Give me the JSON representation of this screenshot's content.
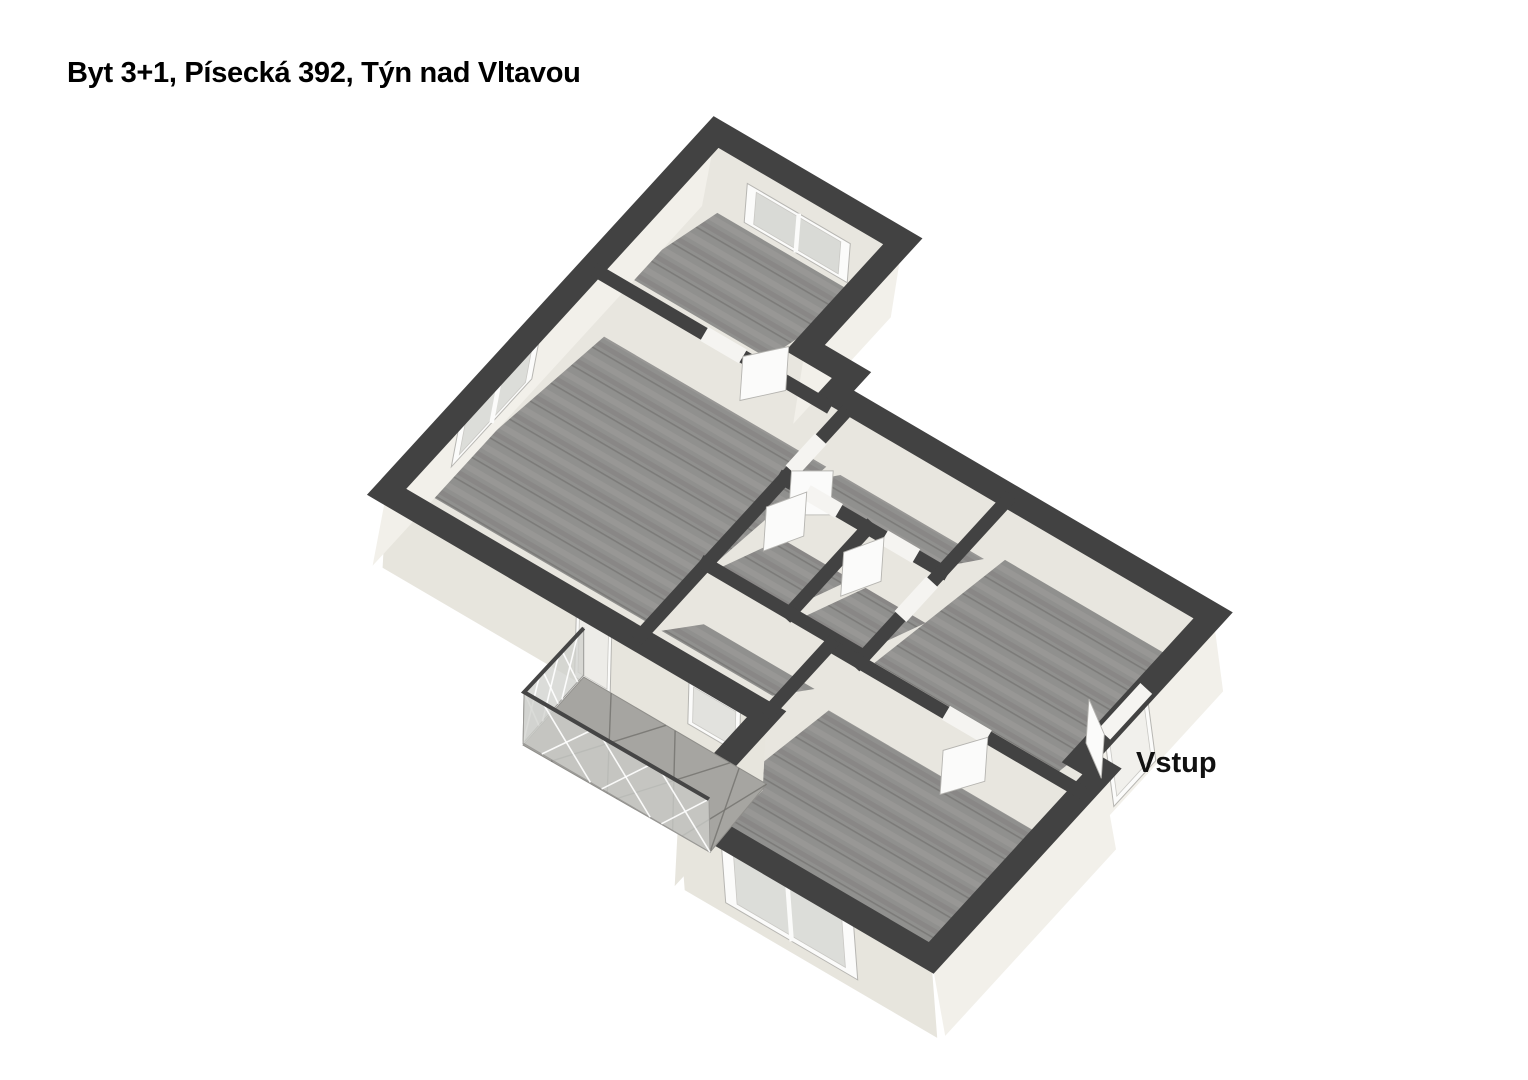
{
  "header": {
    "title": "Byt 3+1, Písecká 392, Týn nad Vltavou"
  },
  "plan": {
    "entrance_label": "Vstup",
    "projection": {
      "origin": [
        716,
        132
      ],
      "u": [
        64.4,
        37.7
      ],
      "v": [
        -48.8,
        53.3
      ],
      "floor_drop": [
        -4,
        50
      ],
      "near_tuck": [
        0,
        6
      ],
      "leaf_drop": [
        -3,
        44
      ]
    },
    "colors": {
      "background": "#ffffff",
      "wall_top": "#424242",
      "wall_face": "#e8e6df",
      "facade_light": "#f2f0ea",
      "facade_dark": "#e7e5dd",
      "floor_base": "#90908e",
      "floor_seam": "#7c7b79",
      "floor_light": "#9a9997",
      "floor_dark": "#868482",
      "white_joinery": "#fbfbfa",
      "glazing": "#d9dad6",
      "deck": "#a6a5a1",
      "glass": "rgba(207,208,204,0.75)",
      "rail": "#454545"
    },
    "boundary": [
      [
        0,
        0
      ],
      [
        2.9,
        0
      ],
      [
        2.9,
        2.0
      ],
      [
        3.62,
        2.0
      ],
      [
        3.62,
        2.35
      ],
      [
        9.5,
        2.35
      ],
      [
        9.5,
        5.05
      ],
      [
        9.82,
        5.05
      ],
      [
        9.82,
        8.55
      ],
      [
        5.9,
        8.55
      ],
      [
        5.9,
        6.75
      ],
      [
        0,
        6.75
      ]
    ],
    "boundary_stroke": 25,
    "interior_stroke": 13.5,
    "facades": [
      {
        "name": "facade-east-top-room",
        "a": [
          2.9,
          0
        ],
        "b": [
          2.9,
          2.0
        ],
        "lean": -12,
        "depth": 76,
        "tone": "light"
      },
      {
        "name": "facade-east-entrance",
        "a": [
          9.5,
          2.35
        ],
        "b": [
          9.5,
          5.05
        ],
        "lean": 10,
        "depth": 76,
        "tone": "light"
      },
      {
        "name": "facade-east-bottom-room",
        "a": [
          9.82,
          5.05
        ],
        "b": [
          9.82,
          8.55
        ],
        "lean": 14,
        "depth": 78,
        "tone": "light"
      },
      {
        "name": "facade-south-bottom-room",
        "a": [
          9.82,
          8.55
        ],
        "b": [
          5.9,
          8.55
        ],
        "lean": 6,
        "depth": 80,
        "tone": "dark"
      },
      {
        "name": "facade-west-bottom-room",
        "a": [
          5.9,
          8.55
        ],
        "b": [
          5.9,
          6.75
        ],
        "lean": -4,
        "depth": 76,
        "tone": "dark"
      },
      {
        "name": "facade-south-living",
        "a": [
          5.9,
          6.75
        ],
        "b": [
          0,
          6.75
        ],
        "lean": -4,
        "depth": 76,
        "tone": "dark"
      },
      {
        "name": "facade-west-living",
        "a": [
          0,
          6.75
        ],
        "b": [
          0,
          0
        ],
        "lean": -14,
        "depth": 74,
        "tone": "light"
      }
    ],
    "rooms": [
      {
        "name": "bedroom-top",
        "rect": [
          0.34,
          0.34,
          2.56,
          2.32
        ]
      },
      {
        "name": "living-room",
        "rect": [
          0.34,
          2.66,
          3.79,
          6.41
        ]
      },
      {
        "name": "hall-corridor",
        "rect": [
          4.01,
          2.66,
          6.24,
          3.64
        ]
      },
      {
        "name": "bathroom",
        "rect": [
          4.01,
          3.86,
          5.09,
          5.24
        ]
      },
      {
        "name": "wc",
        "rect": [
          5.31,
          3.86,
          6.24,
          5.24
        ]
      },
      {
        "name": "hall-south",
        "rect": [
          4.01,
          5.46,
          5.73,
          6.41
        ]
      },
      {
        "name": "entrance-hall",
        "rect": [
          6.46,
          2.52,
          9.33,
          5.28
        ]
      },
      {
        "name": "bedroom-bottom",
        "rect": [
          6.07,
          5.62,
          9.65,
          8.38
        ]
      }
    ],
    "interior_walls": [
      {
        "name": "wall-top-room-south",
        "seg": [
          [
            0.12,
            2.55
          ],
          [
            3.62,
            2.55
          ]
        ]
      },
      {
        "name": "wall-living-east",
        "seg": [
          [
            3.9,
            2.55
          ],
          [
            3.9,
            6.68
          ]
        ]
      },
      {
        "name": "wall-bath-north",
        "seg": [
          [
            3.9,
            3.75
          ],
          [
            6.35,
            3.75
          ]
        ]
      },
      {
        "name": "wall-bath-wc-divider",
        "seg": [
          [
            5.2,
            3.75
          ],
          [
            5.2,
            5.35
          ]
        ]
      },
      {
        "name": "wall-bath-south",
        "seg": [
          [
            3.9,
            5.35
          ],
          [
            6.35,
            5.35
          ]
        ]
      },
      {
        "name": "wall-entrance-west",
        "seg": [
          [
            6.35,
            2.42
          ],
          [
            6.35,
            5.45
          ]
        ]
      },
      {
        "name": "wall-bottom-room-north",
        "seg": [
          [
            5.9,
            5.45
          ],
          [
            9.75,
            5.45
          ]
        ]
      },
      {
        "name": "wall-hall-south-east",
        "seg": [
          [
            5.9,
            5.45
          ],
          [
            5.9,
            6.68
          ]
        ]
      }
    ],
    "doors": [
      {
        "name": "door-bedroom-top",
        "gap": [
          [
            1.75,
            2.55
          ],
          [
            2.35,
            2.55
          ]
        ],
        "leaf": [
          [
            2.35,
            2.55
          ],
          [
            2.72,
            2.1
          ]
        ]
      },
      {
        "name": "door-living",
        "gap": [
          [
            3.9,
            3.0
          ],
          [
            3.9,
            3.6
          ]
        ],
        "leaf": [
          [
            3.9,
            3.6
          ],
          [
            4.32,
            3.3
          ]
        ]
      },
      {
        "name": "door-bathroom",
        "gap": [
          [
            4.25,
            3.75
          ],
          [
            4.75,
            3.75
          ]
        ],
        "leaf": [
          [
            4.25,
            3.75
          ],
          [
            3.98,
            4.22
          ]
        ]
      },
      {
        "name": "door-wc",
        "gap": [
          [
            5.45,
            3.75
          ],
          [
            5.95,
            3.75
          ]
        ],
        "leaf": [
          [
            5.45,
            3.75
          ],
          [
            5.18,
            4.22
          ]
        ]
      },
      {
        "name": "opening-hall-entrance",
        "gap": [
          [
            6.35,
            3.95
          ],
          [
            6.35,
            4.6
          ]
        ]
      },
      {
        "name": "door-bedroom-bottom",
        "gap": [
          [
            7.7,
            5.45
          ],
          [
            8.35,
            5.45
          ]
        ],
        "leaf": [
          [
            8.35,
            5.45
          ],
          [
            8.02,
            5.93
          ]
        ]
      },
      {
        "name": "door-entrance-vstup",
        "gap": [
          [
            9.5,
            3.72
          ],
          [
            9.5,
            4.58
          ]
        ],
        "leaf": [
          [
            9.5,
            4.58
          ],
          [
            9.02,
            4.26
          ]
        ]
      }
    ],
    "windows": [
      {
        "name": "window-bedroom-top",
        "a": [
          0.75,
          0.34
        ],
        "b": [
          2.35,
          0.34
        ],
        "drop": [
          -4,
          50
        ],
        "t0": 0.1,
        "t1": 0.88,
        "mullion": true,
        "glaze": "#d9dad6"
      },
      {
        "name": "window-living-west",
        "a": [
          0,
          3.55
        ],
        "b": [
          0,
          5.2
        ],
        "drop": [
          -14,
          74
        ],
        "t0": 0.1,
        "t1": 0.78,
        "mullion": true,
        "glaze": "#dcddd9"
      },
      {
        "name": "window-bedroom-bottom",
        "a": [
          6.55,
          8.55
        ],
        "b": [
          8.6,
          8.55
        ],
        "drop": [
          6,
          80
        ],
        "t0": 0.08,
        "t1": 0.85,
        "mullion": true,
        "glaze": "#dcddd9"
      },
      {
        "name": "window-hall-balcony",
        "a": [
          4.7,
          6.75
        ],
        "b": [
          5.5,
          6.75
        ],
        "drop": [
          -2,
          76
        ],
        "t0": 0.15,
        "t1": 0.72,
        "mullion": false,
        "glaze": "#e2e2de"
      },
      {
        "name": "door-balcony",
        "a": [
          2.95,
          6.75
        ],
        "b": [
          3.5,
          6.75
        ],
        "drop": [
          -2,
          76
        ],
        "t0": 0.04,
        "t1": 0.97,
        "mullion": false,
        "glaze": "#edece8"
      },
      {
        "name": "door-vstup-panel",
        "a": [
          9.5,
          3.72
        ],
        "b": [
          9.5,
          4.58
        ],
        "drop": [
          10,
          76
        ],
        "t0": 0.04,
        "t1": 0.95,
        "mullion": false,
        "glaze": "#f1f0ec"
      }
    ],
    "balcony": {
      "deck": [
        [
          3.06,
          6.75
        ],
        [
          5.9,
          6.75
        ],
        [
          5.9,
          7.95
        ],
        [
          3.06,
          7.95
        ]
      ],
      "deck_offsets": [
        [
          0,
          70
        ],
        [
          0,
          70
        ],
        [
          2,
          74
        ],
        [
          -2,
          74
        ]
      ],
      "rail_points": [
        [
          3.06,
          6.75
        ],
        [
          3.06,
          7.95
        ],
        [
          5.9,
          7.95
        ]
      ],
      "rail_top_offsets": [
        [
          0,
          21
        ],
        [
          -1,
          21
        ],
        [
          1,
          21
        ]
      ],
      "glass_bottom_offsets": [
        [
          0,
          68
        ],
        [
          -2,
          72
        ],
        [
          2,
          74
        ]
      ]
    }
  }
}
